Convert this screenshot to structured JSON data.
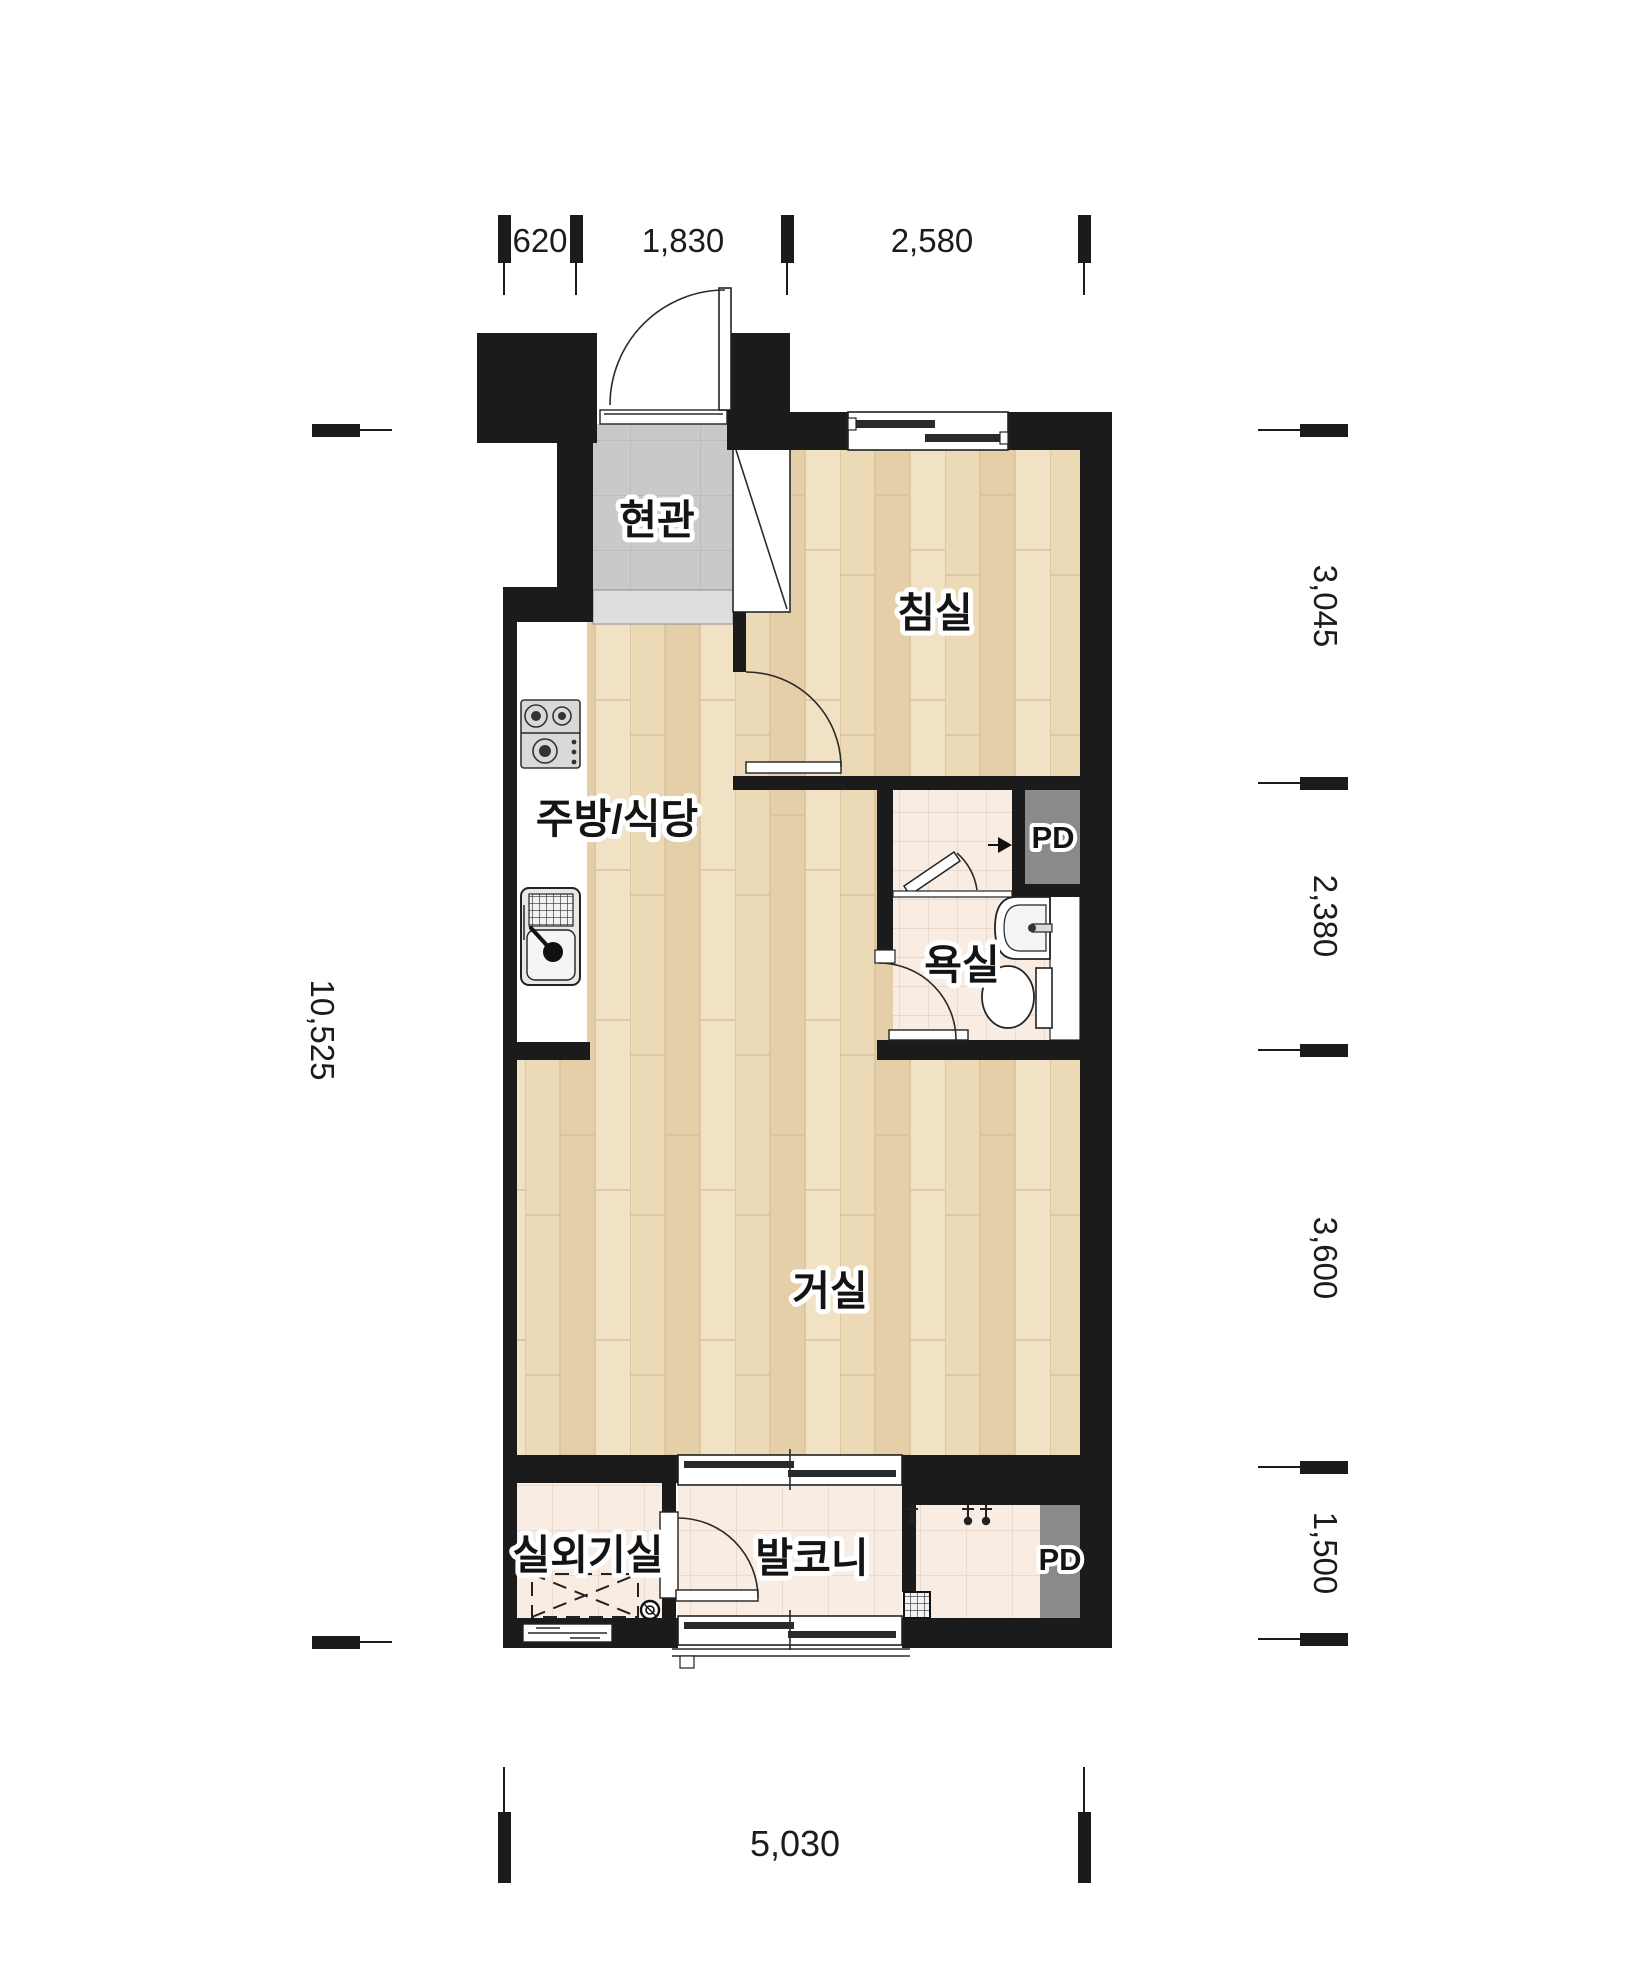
{
  "rooms": {
    "entrance": "현관",
    "bedroom": "침실",
    "kitchen_dining": "주방/식당",
    "bathroom": "욕실",
    "living_room": "거실",
    "ac_unit_room": "실외기실",
    "balcony": "발코니",
    "pd_upper": "PD",
    "pd_lower": "PD"
  },
  "dims": {
    "top": [
      "620",
      "1,830",
      "2,580"
    ],
    "right": [
      "3,045",
      "2,380",
      "3,600",
      "1,500"
    ],
    "left": [
      "10,525"
    ],
    "bottom": [
      "5,030"
    ]
  },
  "colors": {
    "wall": "#1b1b1b",
    "wood_floor": "#ebd8b4",
    "warm_tile": "#f8ece3",
    "entrance_tile": "#c9c9c9",
    "pd_fill": "#8a8a8a",
    "background": "#ffffff"
  }
}
